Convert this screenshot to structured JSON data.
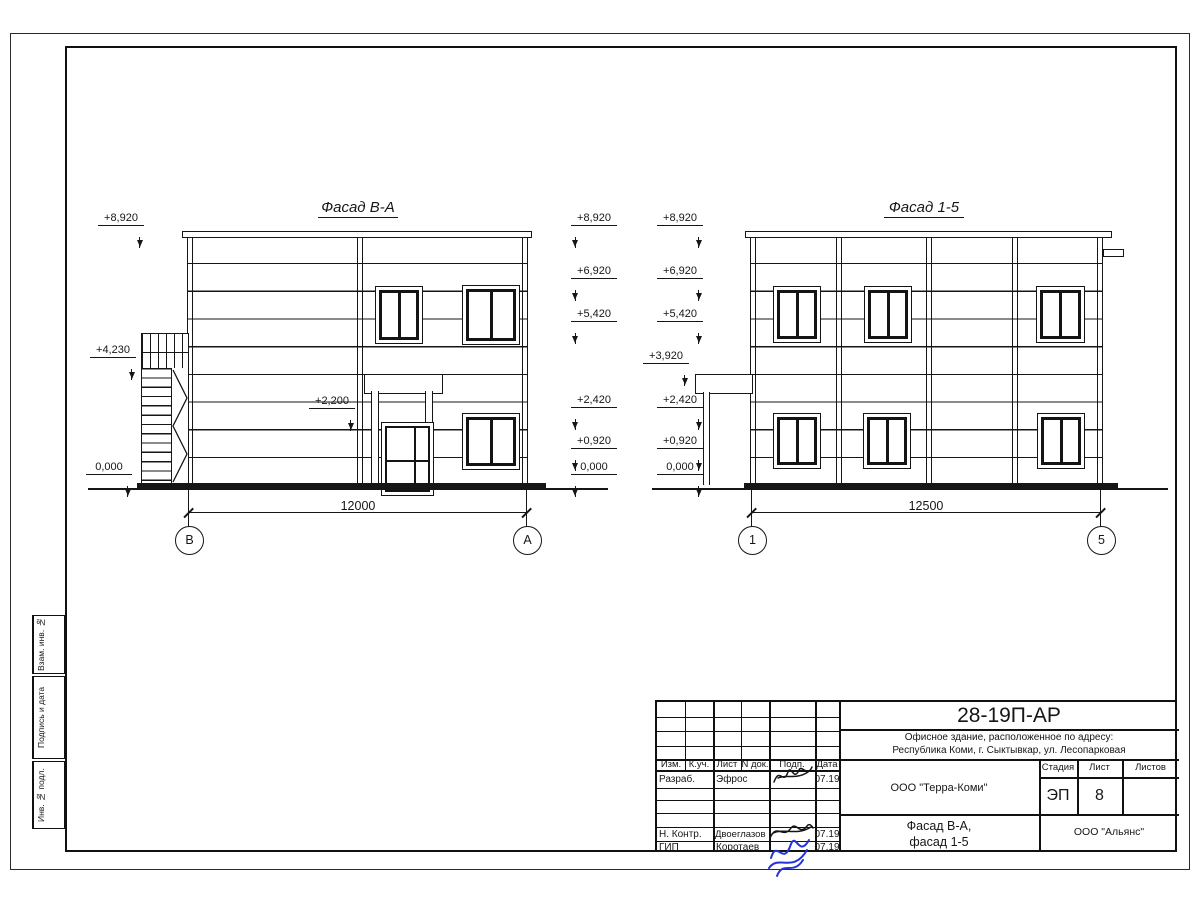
{
  "drawing": {
    "facades": [
      {
        "title": "Фасад В-А",
        "dimension": "12000",
        "axis_left": "В",
        "axis_right": "А",
        "levels_left": [
          "+8,920",
          "+4,230",
          "0,000"
        ],
        "levels_right": [
          "+8,920",
          "+6,920",
          "+5,420",
          "+2,420",
          "+0,920",
          "0,000"
        ],
        "level_inner": "+2,200"
      },
      {
        "title": "Фасад 1-5",
        "dimension": "12500",
        "axis_left": "1",
        "axis_right": "5",
        "levels_left": [
          "+8,920",
          "+6,920",
          "+5,420",
          "+3,920",
          "+2,420",
          "+0,920",
          "0,000"
        ]
      }
    ]
  },
  "side_stamp": {
    "boxes": [
      "Взам. инв. №",
      "Подпись и дата",
      "Инв. № подл."
    ]
  },
  "title_block": {
    "doc_number": "28-19П-АР",
    "address_line1": "Офисное здание, расположенное по адресу:",
    "address_line2": "Республика Коми, г. Сыктывкар, ул. Лесопарковая",
    "col_izm": "Изм.",
    "col_kuch": "К.уч.",
    "col_list": "Лист",
    "col_ndok": "N док.",
    "col_podp": "Подп.",
    "col_data": "Дата",
    "row1_role": "Разраб.",
    "row1_name": "Эфрос",
    "row1_date": "07.19",
    "row2_role": "Н. Контр.",
    "row2_name": "Двоеглазов",
    "row2_date": "07.19",
    "row3_role": "ГИП",
    "row3_name": "Коротаев",
    "row3_date": "07.19",
    "company": "ООО \"Терра-Коми\"",
    "stage_label": "Стадия",
    "sheet_label": "Лист",
    "sheets_label": "Листов",
    "stage": "ЭП",
    "sheet": "8",
    "sheets": "",
    "subtitle_line1": "Фасад В-А,",
    "subtitle_line2": "фасад 1-5",
    "contractor": "ООО \"Альянс\""
  }
}
